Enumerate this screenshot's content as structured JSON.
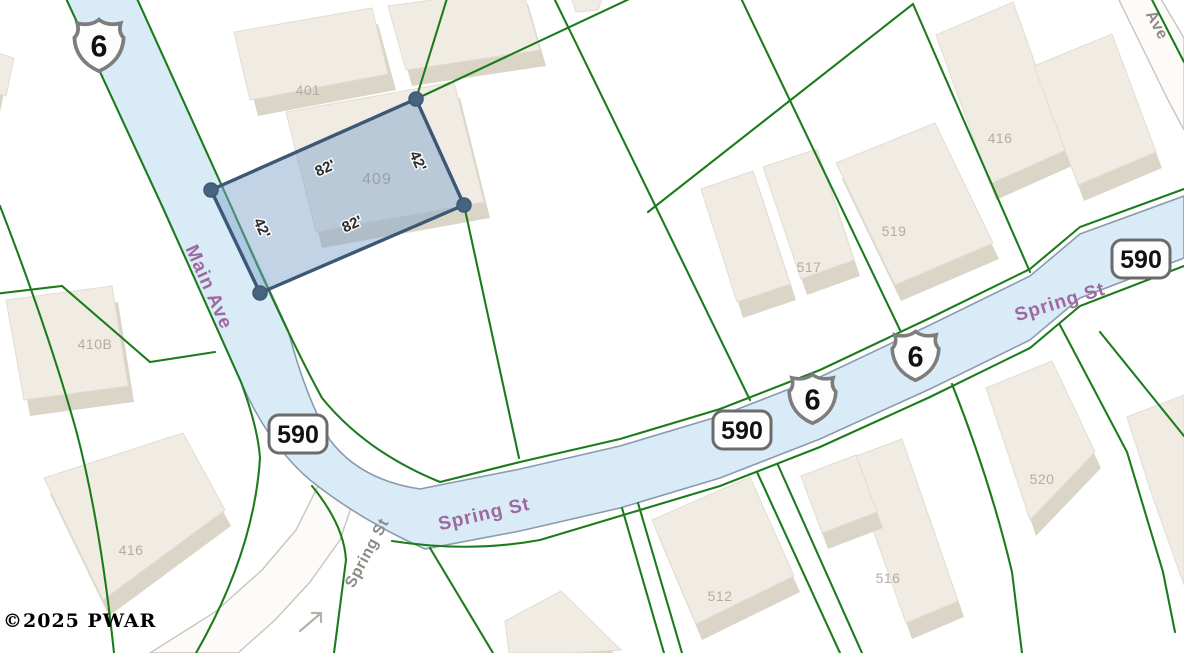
{
  "attribution": {
    "text": "©2025 PWAR"
  },
  "selected_parcel": {
    "number": "409",
    "dim_top": "82'",
    "dim_bottom": "82'",
    "dim_left": "42'",
    "dim_right": "42'"
  },
  "streets": {
    "main_ave": "Main Ave",
    "spring_st": "Spring St",
    "spring_st_side": "Spring St",
    "ave_partial": "Ave"
  },
  "route_shields": [
    {
      "system": "us-route",
      "number": "6"
    },
    {
      "system": "route-590",
      "number": "590"
    }
  ],
  "buildings": [
    {
      "label": "401"
    },
    {
      "label": "410B"
    },
    {
      "label": "416"
    },
    {
      "label": "517"
    },
    {
      "label": "519"
    },
    {
      "label": "416"
    },
    {
      "label": "520"
    },
    {
      "label": "512"
    },
    {
      "label": "516"
    }
  ],
  "colors": {
    "road_fill": "#d8ebf7",
    "road_casing": "#8a9bae",
    "parcel_boundary_green": "#1c7c1c",
    "selected_parcel_fill": "#7fa3ca",
    "selected_parcel_stroke": "#3c5875",
    "street_label_purple": "#9f689e",
    "building_fill": "#f0ece4",
    "building_label_gray": "#b2aea5"
  }
}
